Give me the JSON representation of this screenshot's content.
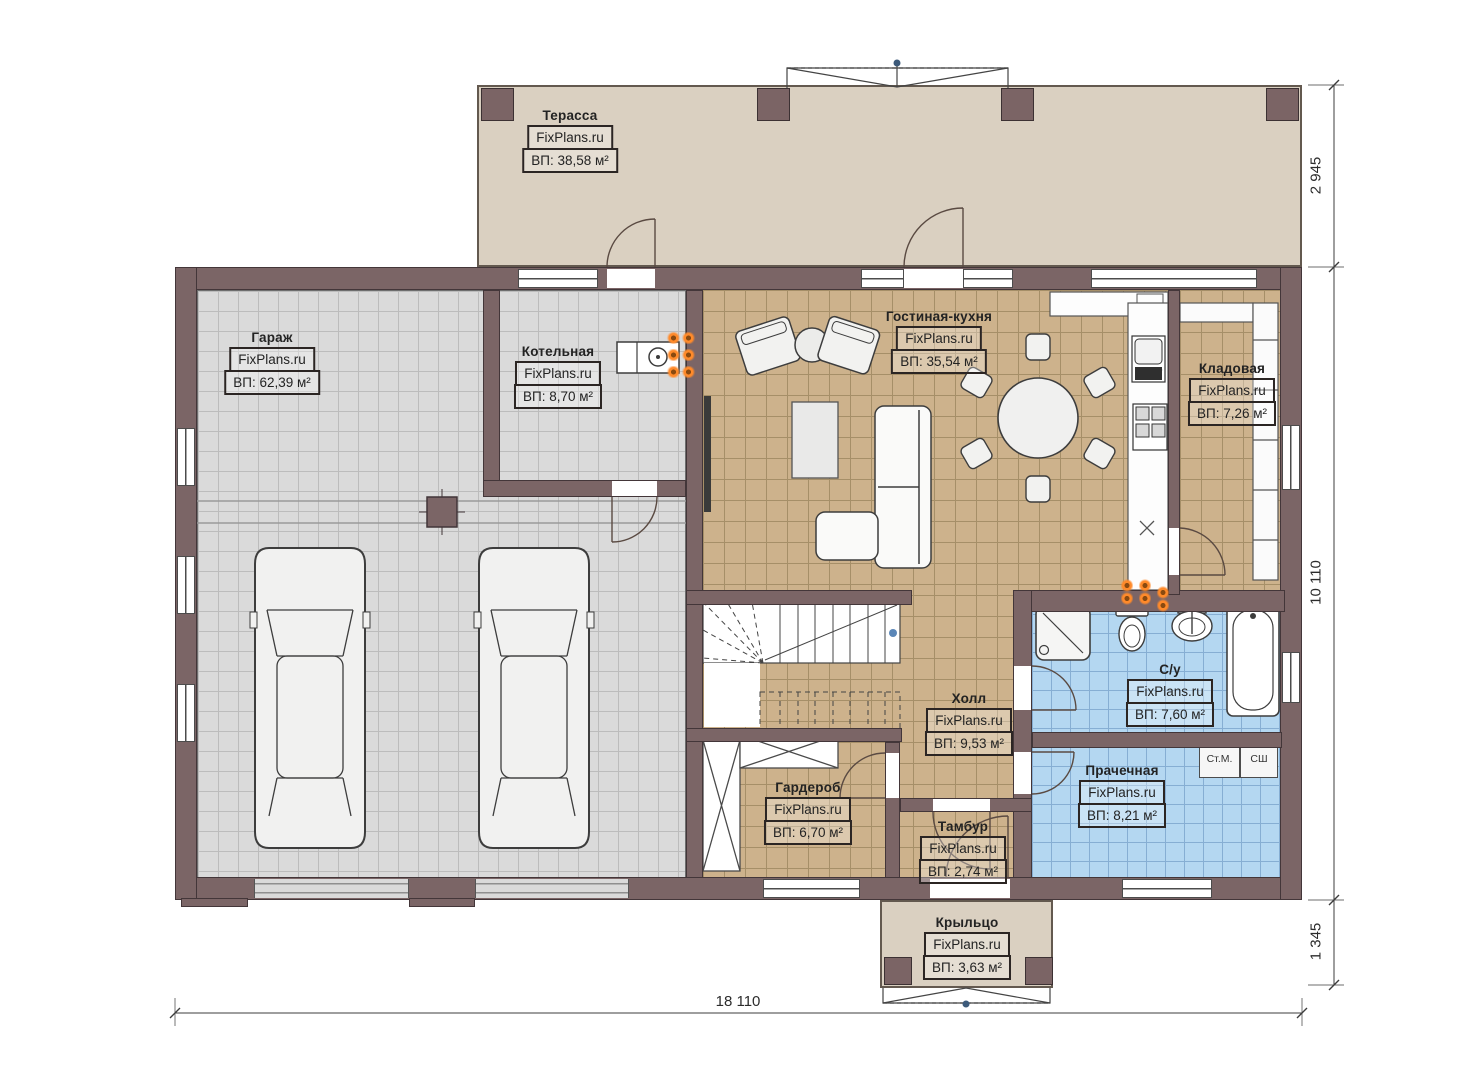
{
  "watermark": "FixPlans.ru",
  "rooms": [
    {
      "name": "Терасса",
      "area": "ВП: 38,58 м²"
    },
    {
      "name": "Гараж",
      "area": "ВП: 62,39 м²"
    },
    {
      "name": "Котельная",
      "area": "ВП: 8,70 м²"
    },
    {
      "name": "Гостиная-кухня",
      "area": "ВП: 35,54 м²"
    },
    {
      "name": "Кладовая",
      "area": "ВП: 7,26 м²"
    },
    {
      "name": "С/у",
      "area": "ВП: 7,60 м²"
    },
    {
      "name": "Холл",
      "area": "ВП: 9,53 м²"
    },
    {
      "name": "Гардероб",
      "area": "ВП: 6,70 м²"
    },
    {
      "name": "Тамбур",
      "area": "ВП: 2,74 м²"
    },
    {
      "name": "Прачечная",
      "area": "ВП: 8,21 м²"
    },
    {
      "name": "Крыльцо",
      "area": "ВП: 3,63 м²"
    }
  ],
  "appliances": {
    "washer": "Ст.М.",
    "dryer": "СШ"
  },
  "dimensions": {
    "right_top": "2 945",
    "right_middle": "10 110",
    "right_bottom": "1 345",
    "bottom": "18 110"
  },
  "colors": {
    "wall": "#7b6566",
    "terrace_floor": "#dad0c1",
    "garage_floor": "#dadada",
    "wood_floor": "#cdb28c",
    "tile_floor": "#b4d7f1",
    "accent_orange": "#ff8a2a"
  }
}
